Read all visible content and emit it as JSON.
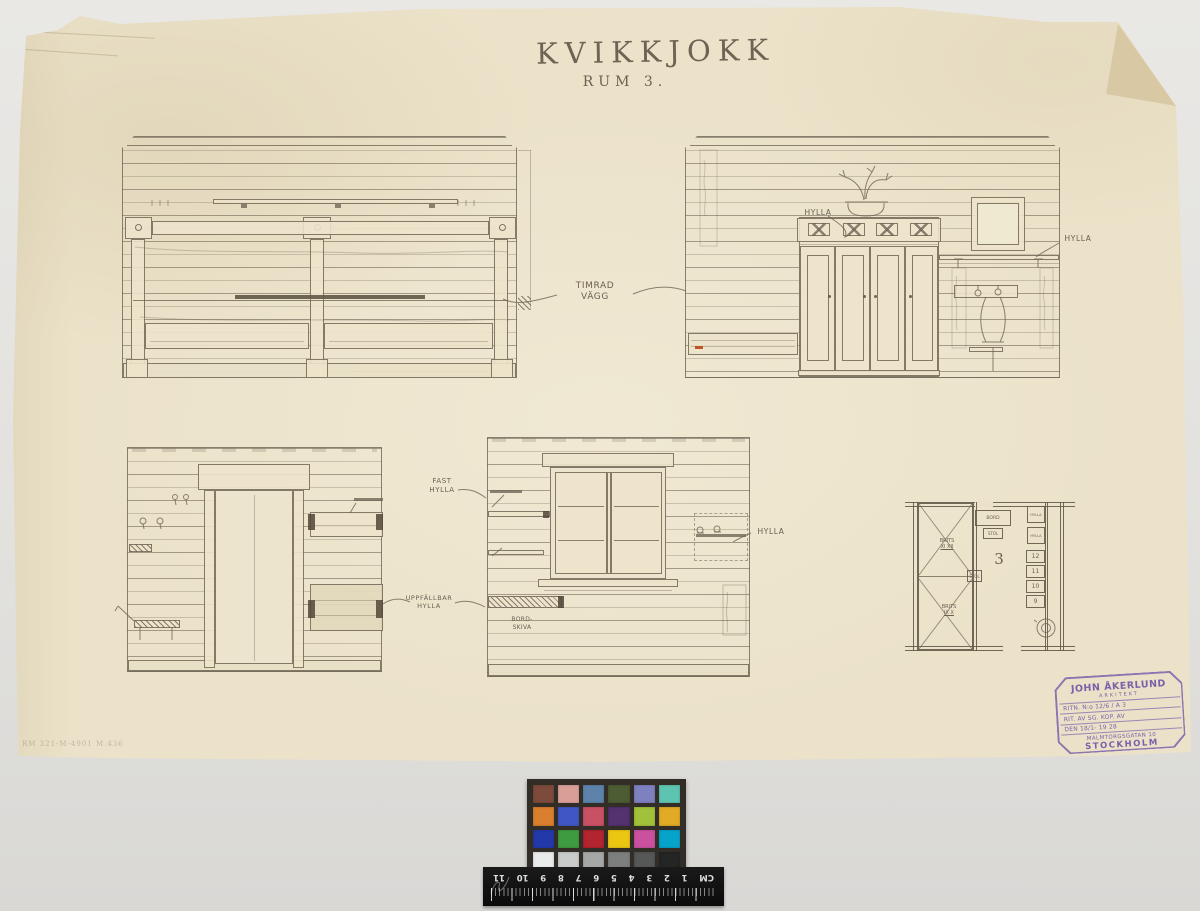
{
  "document": {
    "title": "KVIKKJOKK",
    "subtitle": "RUM 3.",
    "margin_note": "RM 321-M-4901 M.436"
  },
  "annotations": {
    "timrad_line1": "TIMRAD",
    "timrad_line2": "VÄGG",
    "hylla_wardrobe": "HYLLA",
    "hylla_washstand": "HYLLA",
    "fast_line1": "FAST",
    "fast_line2": "HYLLA",
    "uppfallbar_line1": "UPPFÄLLBAR",
    "uppfallbar_line2": "HYLLA",
    "hylla_window": "HYLLA",
    "bordskiva_line1": "BORD-",
    "bordskiva_line2": "SKIVA"
  },
  "floor_plan": {
    "room_number": "3",
    "table_label": "BORD",
    "chair_label": "STOL",
    "chair2_label": "STOL",
    "shelf1_label": "HYLLA",
    "shelf2_label": "HYLLA",
    "bunk_upper_label": "BRITS",
    "bunk_upper_numerals": "XI XII",
    "bunk_lower_label": "BRITS",
    "bunk_lower_numerals": "IX X",
    "bed_numbers": [
      "12",
      "11",
      "10",
      "9"
    ]
  },
  "stamp": {
    "name": "JOHN ÅKERLUND",
    "role": "ARKITEKT",
    "row_drawing_no": "RITN. N:o 12/6 / A 3",
    "row_drawn_by": "RIT. AV SG.  KOP. AV",
    "row_date": "DEN 18/1-  19 28",
    "address": "MALMTORGSGATAN 10",
    "city": "STOCKHOLM",
    "ink_color": "#7b5fae"
  },
  "color_card": {
    "rows": [
      [
        "#7c4b3b",
        "#d99f97",
        "#5d83aa",
        "#4c5c33",
        "#7e81bf",
        "#5ec4b2"
      ],
      [
        "#d97f2e",
        "#4156c5",
        "#c95165",
        "#54316f",
        "#a2c13a",
        "#e2aa25"
      ],
      [
        "#2339aa",
        "#3f9b40",
        "#b2242f",
        "#ebc712",
        "#ca519e",
        "#06a4ca"
      ],
      [
        "#e9eaea",
        "#c9caca",
        "#a6a7a7",
        "#7d7e7e",
        "#565757",
        "#242525"
      ]
    ]
  },
  "ruler": {
    "numbers": [
      "CM",
      "1",
      "2",
      "3",
      "4",
      "5",
      "6",
      "7",
      "8",
      "9",
      "10",
      "11"
    ]
  }
}
